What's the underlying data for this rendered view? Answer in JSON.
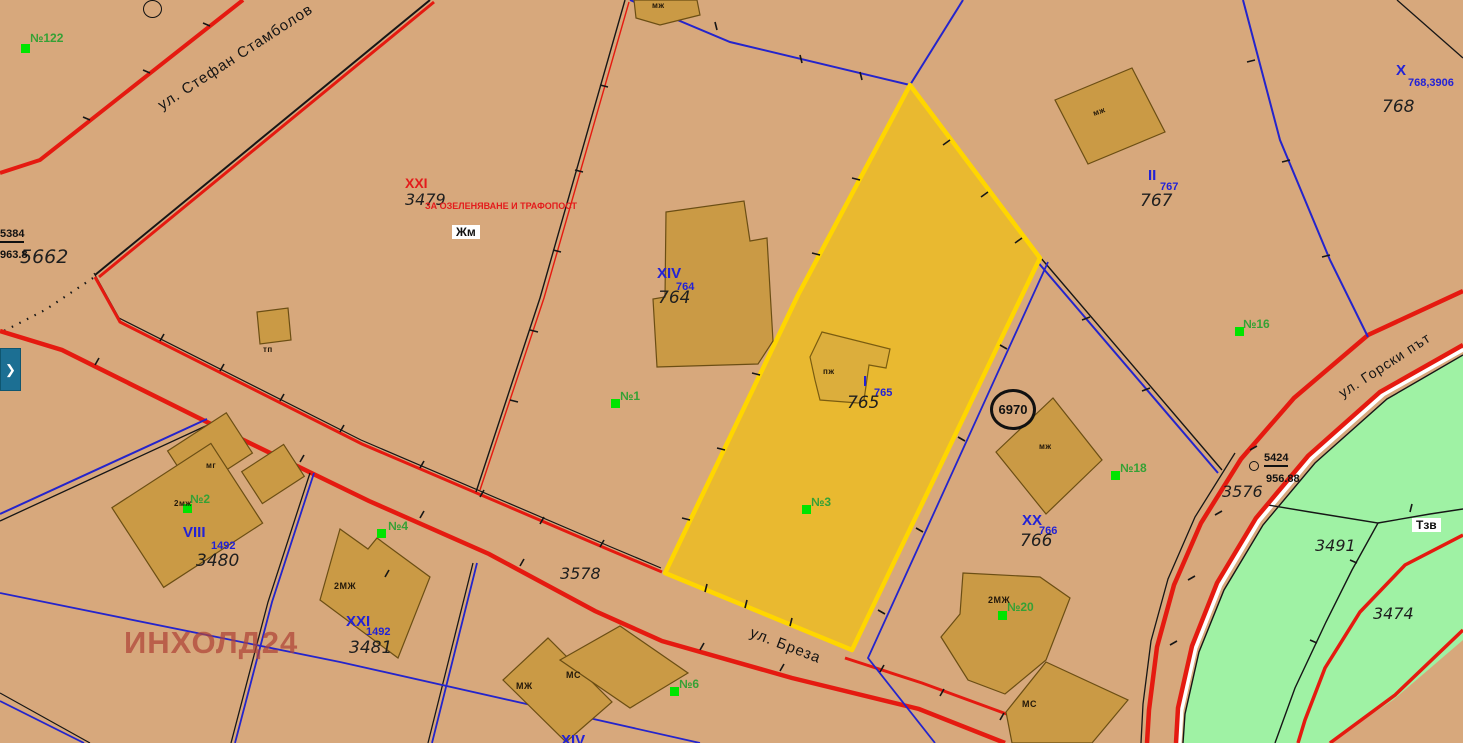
{
  "map_title": "cadastral-regulation-plan-view",
  "streets": {
    "stamboliov": "ул. Стефан Стамболов",
    "breza": "ул. Бреза",
    "gorski": "ул. Горски път"
  },
  "parcels": {
    "p3479": {
      "upi": "XXI",
      "cadastral": "3479",
      "note": "ЗА ОЗЕЛЕНЯВАНЕ И ТРАФОПОСТ"
    },
    "p764": {
      "upi": "XIV",
      "plan": "764",
      "cadastral": "764"
    },
    "p765": {
      "upi": "I",
      "plan": "765",
      "cadastral": "765",
      "highlighted": true
    },
    "p767": {
      "upi": "II",
      "plan": "767",
      "cadastral": "767"
    },
    "p768": {
      "upi": "X",
      "plan": "768,3906",
      "cadastral": "768"
    },
    "p766": {
      "upi": "XX",
      "plan": "766",
      "cadastral": "766"
    },
    "p3480": {
      "upi": "VIII",
      "plan": "1492",
      "cadastral": "3480"
    },
    "p3481": {
      "upi": "XXI",
      "plan": "1492",
      "cadastral": "3481"
    },
    "p5662": {
      "cadastral": "5662"
    },
    "p3576": {
      "cadastral": "3576"
    },
    "p3578": {
      "cadastral": "3578"
    },
    "p3491": {
      "cadastral": "3491"
    },
    "p3474": {
      "cadastral": "3474"
    },
    "cut_bottom": {
      "upi": "XIV"
    }
  },
  "zone_boxes": {
    "jm": "Жм",
    "tzv": "Тзв"
  },
  "survey_points": {
    "pt5384": {
      "id": "5384",
      "elevation": "963.8"
    },
    "pt5424": {
      "id": "5424",
      "elevation": "956.88"
    }
  },
  "point_circle_label": "6970",
  "address_markers": {
    "m122": "№122",
    "m1": "№1",
    "m2": "№2",
    "m3": "№3",
    "m4": "№4",
    "m6": "№6",
    "m16": "№16",
    "m18": "№18",
    "m20": "№20"
  },
  "building_labels": {
    "mj_top": "мж",
    "mj_topright": "мж",
    "tp": "тп",
    "pj": "пж",
    "mj_diamond": "мж",
    "mg": "мг",
    "mj2_small": "2мж",
    "mj2_3481": "2МЖ",
    "mj_bottom": "МЖ",
    "ms_bottom": "МС",
    "mj2_20": "2МЖ",
    "ms_right": "МС"
  },
  "watermark": "ИНХОЛД24",
  "icons": {
    "expand_arrow": "❯"
  },
  "colors": {
    "background": "#d7a87c",
    "building_fill": "#ca9a45",
    "highlight_fill": "#e9b930",
    "highlight_border": "#ffd600",
    "road_red": "#e51a10",
    "regulation_blue": "#2424cc",
    "green_area": "#9ff2a4",
    "marker_green": "#00e400",
    "address_text_green": "#35a135",
    "red_text": "#e31c1c",
    "blue_text": "#2222d6",
    "watermark_red": "#b2463a",
    "panel_button_teal": "#1c6f93"
  }
}
